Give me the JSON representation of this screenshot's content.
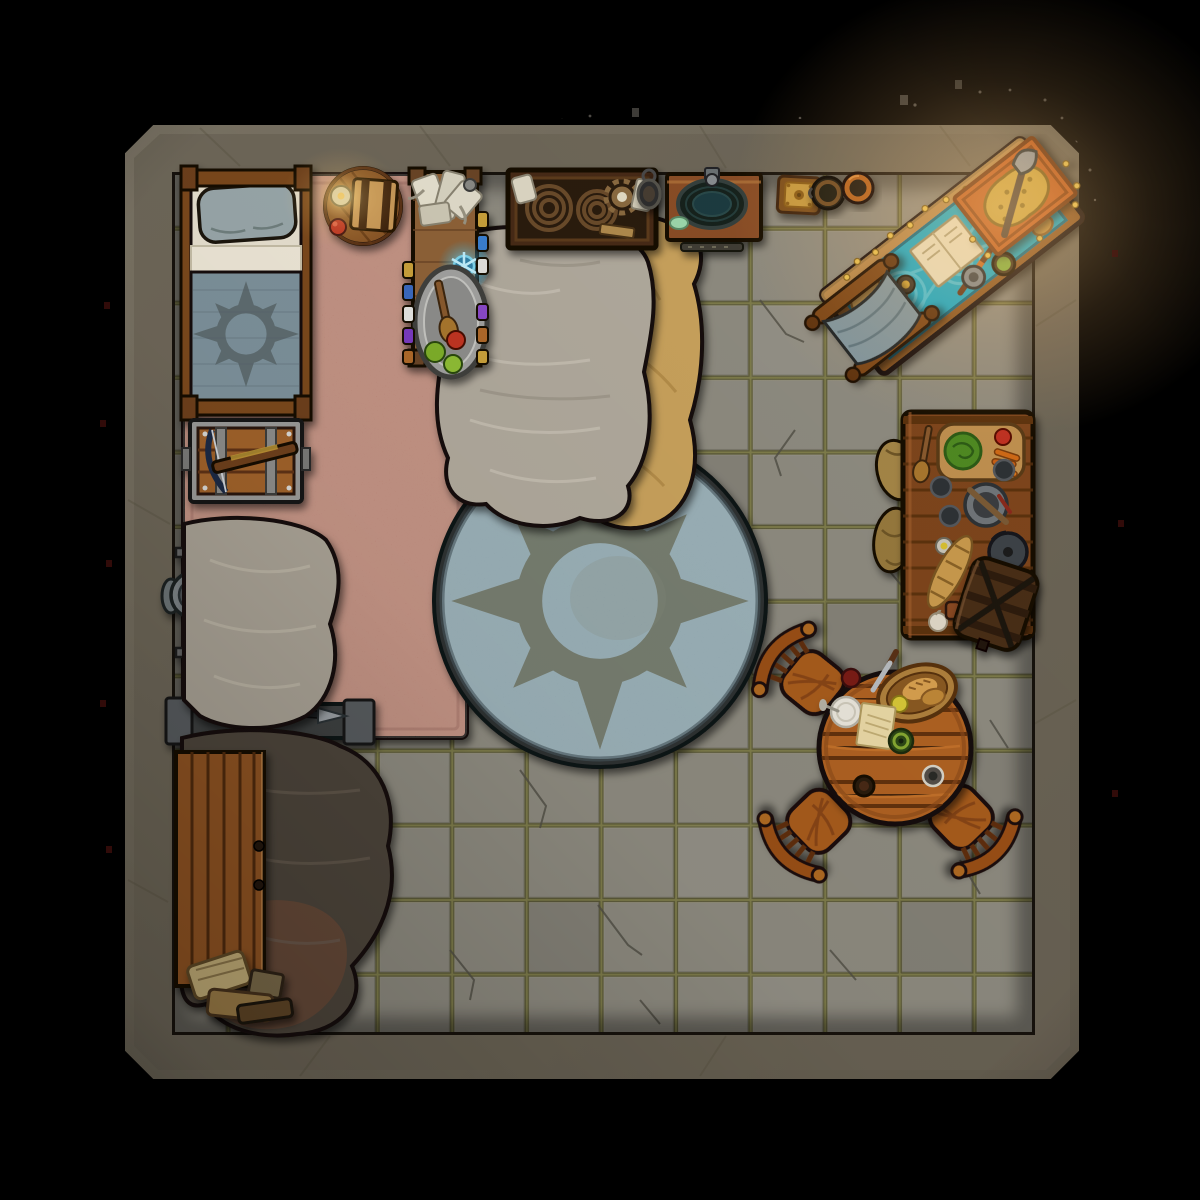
{
  "scene": {
    "type": "top-down fantasy battle map of a single-room stone dwelling",
    "room": {
      "walls": "thick grey stone frame with chamfered corners",
      "floor": "cracked grey flagstone tiles with olive grout",
      "grid": {
        "columns": 11,
        "rows": 11,
        "tile_size_px": 74
      }
    },
    "palette": {
      "background": "#000000",
      "wall_stone": "#6f6859",
      "wall_stone_light": "#8a8374",
      "floor_tile": "#8e8b80",
      "floor_grout": "#7d7a42",
      "round_rug": "#8ba4ad",
      "rug_emblem": "#6e705c",
      "salmon_rug": "#b97f6e",
      "teal_cloth": "#17a9c8",
      "wood_dark": "#7e441c",
      "wood_mid": "#8a5628",
      "wood_bright": "#b06222",
      "fur_grey": "#b1aa9d",
      "fur_tan": "#c9a25b",
      "fur_dark": "#4e453b",
      "blanket_blue": "#7e929c",
      "metal_grey": "#84898c",
      "gold": "#d8a838",
      "crystal_glow": "#5ad0f2"
    },
    "lighting": {
      "warm_glow": "northeast corner near treasure desk",
      "candle": "bedside round table",
      "crystal": "alchemy side table"
    },
    "furniture": [
      {
        "name": "bed-with-sun-blanket",
        "location": "top-left against north and west walls",
        "items": [
          "grey pillow",
          "cream sheets",
          "blue blanket with dark sun emblem"
        ]
      },
      {
        "name": "bedside-round-table",
        "location": "top-left",
        "items": [
          "candle",
          "red apple",
          "strapped book chest"
        ]
      },
      {
        "name": "salmon-area-rug",
        "location": "top-left quadrant"
      },
      {
        "name": "banded-chest-with-crossbow",
        "location": "west wall below bed"
      },
      {
        "name": "armor-stand",
        "location": "west wall middle"
      },
      {
        "name": "kite-shield",
        "location": "west wall middle"
      },
      {
        "name": "tool-bench-with-valuables",
        "location": "west lower-middle",
        "items": [
          "gold coins",
          "ring",
          "daggers",
          "tools"
        ]
      },
      {
        "name": "grey-fur-rug-west",
        "location": "west middle"
      },
      {
        "name": "dark-fur-rug",
        "location": "southwest"
      },
      {
        "name": "plank-cabinet",
        "location": "southwest corner"
      },
      {
        "name": "firewood-and-papers-pile",
        "location": "southwest corner"
      },
      {
        "name": "alchemy-side-table",
        "location": "north, left of center",
        "items": [
          "scrolls",
          "glowing blue crystal",
          "silver platter with spoon and apples",
          "potion bottles"
        ]
      },
      {
        "name": "crate-of-rope-and-gears",
        "location": "north wall center"
      },
      {
        "name": "hand-mirror",
        "location": "north wall center"
      },
      {
        "name": "washstand-with-basin",
        "location": "north wall center-right",
        "items": [
          "dark water basin",
          "soap",
          "towel rail"
        ]
      },
      {
        "name": "ornate-cushion",
        "location": "north wall right"
      },
      {
        "name": "cauldron",
        "location": "north wall right"
      },
      {
        "name": "clay-pot",
        "location": "north wall right"
      },
      {
        "name": "treasure-desk-with-teal-cloth",
        "location": "northeast corner, diagonal",
        "items": [
          "bread loaves",
          "open book",
          "saucer",
          "mace",
          "tankard",
          "soup pot",
          "scattered gold coins"
        ]
      },
      {
        "name": "treasure-pile-on-orange-mat",
        "location": "northeast corner",
        "items": [
          "gold coin pile",
          "war axe"
        ]
      },
      {
        "name": "folding-camp-stool",
        "location": "northeast beside desk"
      },
      {
        "name": "grain-sacks",
        "location": "east beside kitchen counter"
      },
      {
        "name": "kitchen-counter",
        "location": "east wall",
        "items": [
          "cutting board with cabbage, tomato, carrots",
          "wooden spoon",
          "mortar and pestle",
          "cups",
          "baguette",
          "kettle",
          "garlic",
          "jar"
        ]
      },
      {
        "name": "barrel",
        "location": "east wall, south end of counter"
      },
      {
        "name": "round-dining-table",
        "location": "southeast",
        "items": [
          "knife",
          "red dish",
          "bread basket with pear",
          "white plate",
          "parchment",
          "green plate",
          "two cups"
        ]
      },
      {
        "name": "dining-chair",
        "location": "northwest of dining table"
      },
      {
        "name": "dining-chair",
        "location": "southwest of dining table"
      },
      {
        "name": "dining-chair",
        "location": "southeast of dining table"
      },
      {
        "name": "tan-fur-rug",
        "location": "north of center, under grey fur"
      },
      {
        "name": "grey-fur-rug-center",
        "location": "north of center"
      },
      {
        "name": "round-sun-emblem-rug",
        "location": "center of room"
      }
    ]
  }
}
